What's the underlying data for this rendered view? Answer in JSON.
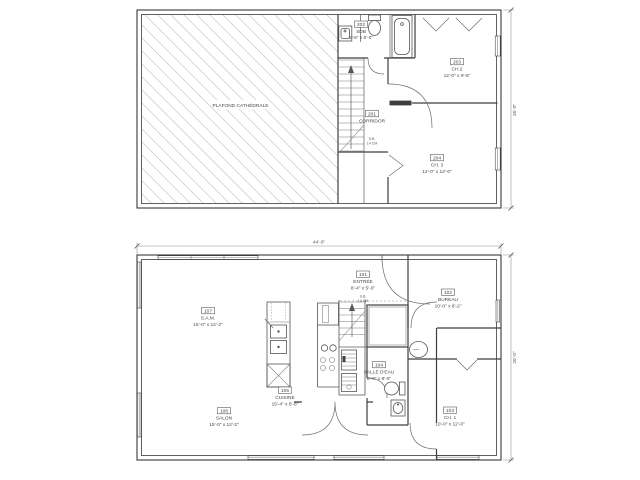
{
  "colors": {
    "background": "#ffffff",
    "wall_line": "#3a3a3a",
    "hatch_line": "#bcbcbc",
    "text": "#474747"
  },
  "upper_floor": {
    "title": "upper floor plan",
    "dim_right": "26'-0\"",
    "plafond_label": "PLAFOND CATHÉDRALE",
    "stair_note": [
      "S.B.",
      "14 CM"
    ],
    "rooms": [
      {
        "number": "202",
        "name": "SDB",
        "dims": "6'-6\" x 6'-0\""
      },
      {
        "number": "203",
        "name": "CH.2",
        "dims": "12'-0\" x 9'-8\""
      },
      {
        "number": "201",
        "name": "CORRIDOR",
        "dims": ""
      },
      {
        "number": "204",
        "name": "CH. 3",
        "dims": "12'-0\" x 12'-0\""
      }
    ]
  },
  "lower_floor": {
    "title": "main floor plan",
    "dim_top": "44'-0\"",
    "dim_right": "26'-0\"",
    "stair_note": [
      "S.B.",
      "14 CM"
    ],
    "rooms": [
      {
        "number": "101",
        "name": "ENTRÉE",
        "dims": "8'-4\" x 5'-0\""
      },
      {
        "number": "107",
        "name": "S.A.M.",
        "dims": "15'-0\" x 12'-2\""
      },
      {
        "number": "102",
        "name": "BUREAU",
        "dims": "10'-0\" x 8'-2\""
      },
      {
        "number": "104",
        "name": "SALLE D'EAU",
        "dims": "8'-0\" x 8'-0\""
      },
      {
        "number": "105",
        "name": "CUISINE",
        "dims": "15'-4\" x 8'-8\""
      },
      {
        "number": "106",
        "name": "SALON",
        "dims": "15'-0\" x 12'-2\""
      },
      {
        "number": "103",
        "name": "CH. 1",
        "dims": "10'-0\" x 12'-0\""
      }
    ]
  }
}
